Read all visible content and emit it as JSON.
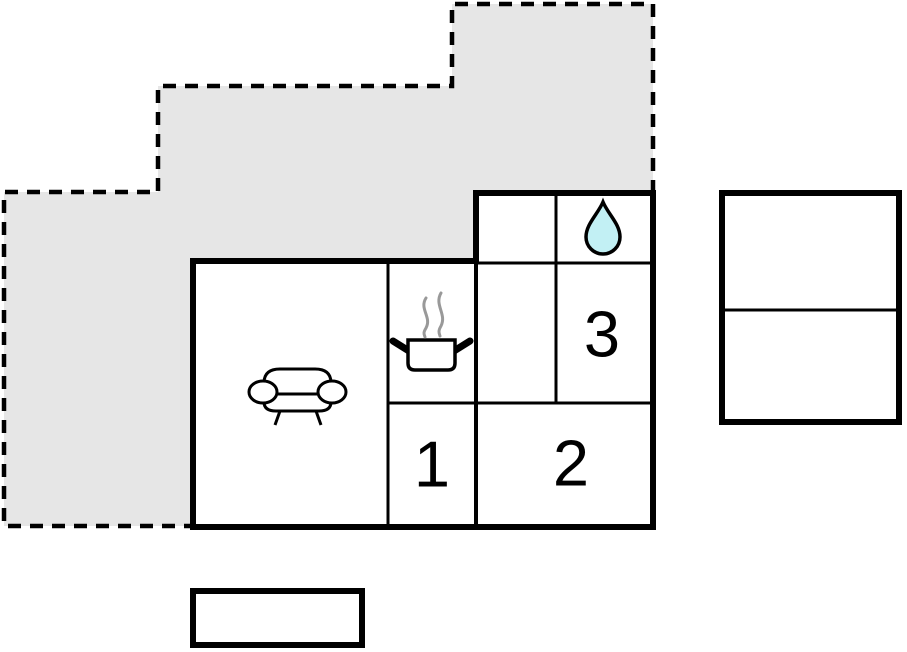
{
  "floorplan": {
    "title": "holiday-home-floor-plan",
    "rooms": [
      {
        "id": "room-1",
        "label": "1"
      },
      {
        "id": "room-2",
        "label": "2"
      },
      {
        "id": "room-3",
        "label": "3"
      }
    ],
    "icons": [
      {
        "name": "sofa-icon"
      },
      {
        "name": "cooking-pot-icon"
      },
      {
        "name": "steam-icon"
      },
      {
        "name": "water-drop-icon"
      }
    ],
    "colors": {
      "background": "#ffffff",
      "terrace_fill": "#e6e6e6",
      "wall": "#000000",
      "water_drop_fill": "#c2f0f4",
      "steam": "#999999",
      "room_interior": "#ffffff"
    }
  }
}
